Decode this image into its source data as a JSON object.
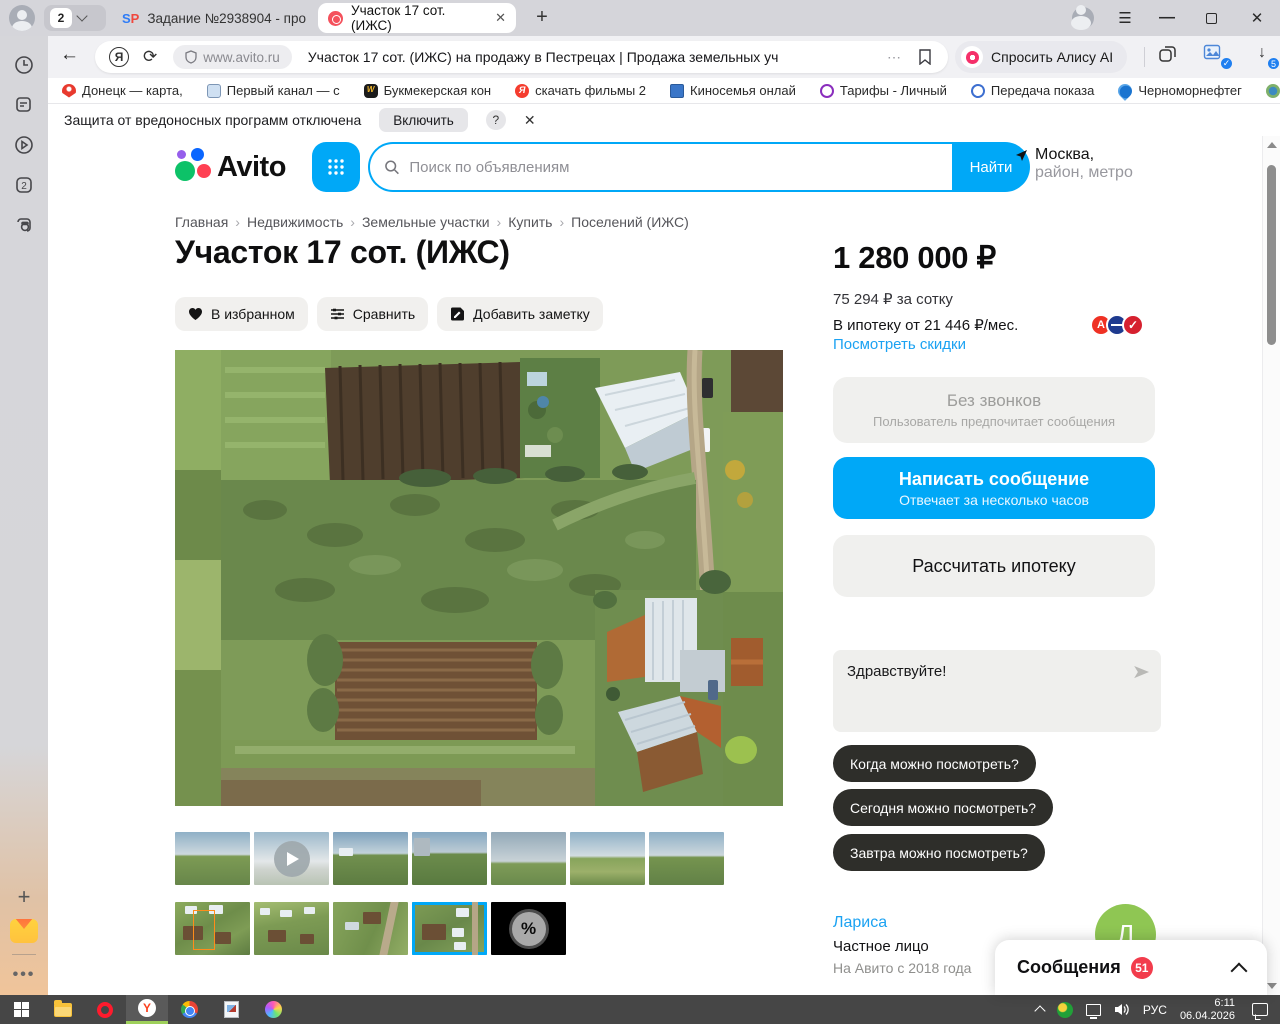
{
  "colors": {
    "accent_blue": "#00a8f7",
    "link_blue": "#1ba2f2",
    "badge_red": "#f23c4c",
    "pill_dark": "#2e2e2a",
    "selected_thumb": "#00a8f7",
    "avatar_green": "#8fc653"
  },
  "browser": {
    "tab_count": "2",
    "tabs": [
      {
        "favicon": "SP",
        "label": "Задание №2938904 - про"
      },
      {
        "label": "Участок 17 сот. (ИЖС)",
        "close": "✕"
      }
    ],
    "newtab_label": "+",
    "address": {
      "domain": "www.avito.ru",
      "page_title": "Участок 17 сот. (ИЖС) на продажу в Пестрецах | Продажа земельных уча...",
      "more": "⋯"
    },
    "alice_button": "Спросить Алису AI",
    "downloads_badge": "5",
    "ext_check": "✓",
    "bookmarks": [
      {
        "label": "Донецк — карта,"
      },
      {
        "label": "Первый канал — с"
      },
      {
        "label": "Букмекерская кон"
      },
      {
        "label": "скачать фильмы 2"
      },
      {
        "label": "Киносемья онлай"
      },
      {
        "label": "Тарифы - Личный"
      },
      {
        "label": "Передача показа"
      },
      {
        "label": "Черноморнефтег"
      },
      {
        "label": "Кому"
      }
    ],
    "bookmarks_overflow": "»",
    "notification": {
      "text": "Защита от вредоносных программ отключена",
      "button": "Включить",
      "help": "?",
      "close": "✕"
    }
  },
  "header": {
    "logo_text": "Avito",
    "search_placeholder": "Поиск по объявлениям",
    "search_button": "Найти",
    "location_line1": "Москва,",
    "location_line2": "район, метро"
  },
  "breadcrumbs": [
    {
      "label": "Главная"
    },
    {
      "label": "Недвижимость"
    },
    {
      "label": "Земельные участки"
    },
    {
      "label": "Купить"
    },
    {
      "label": "Поселений (ИЖС)"
    }
  ],
  "listing": {
    "title": "Участок 17 сот. (ИЖС)",
    "actions": [
      {
        "label": "В избранном"
      },
      {
        "label": "Сравнить"
      },
      {
        "label": "Добавить заметку"
      }
    ],
    "price": "1 280 000 ₽",
    "price_per_unit": "75 294 ₽ за сотку",
    "mortgage_line": "В ипотеку от 21 446 ₽/мес.",
    "bank1_letter": "А",
    "bank3_mark": "✓",
    "discounts_link": "Посмотреть скидки",
    "no_calls_title": "Без звонков",
    "no_calls_subtitle": "Пользователь предпочитает сообщения",
    "write_message": "Написать сообщение",
    "write_message_sub": "Отвечает за несколько часов",
    "mortgage_button": "Рассчитать ипотеку",
    "chat_draft": "Здравствуйте!",
    "quick_questions": [
      {
        "label": "Когда можно посмотреть?"
      },
      {
        "label": "Сегодня можно посмотреть?"
      },
      {
        "label": "Завтра можно посмотреть?"
      }
    ],
    "seller": {
      "name": "Лариса",
      "type": "Частное лицо",
      "since": "На Авито с 2018 года",
      "avatar_letter": "Л"
    },
    "discount_badge": "%"
  },
  "messages_popup": {
    "label": "Сообщения",
    "badge": "51"
  },
  "taskbar": {
    "lang": "РУС",
    "time": "6:11",
    "date": "06.04.2026"
  }
}
